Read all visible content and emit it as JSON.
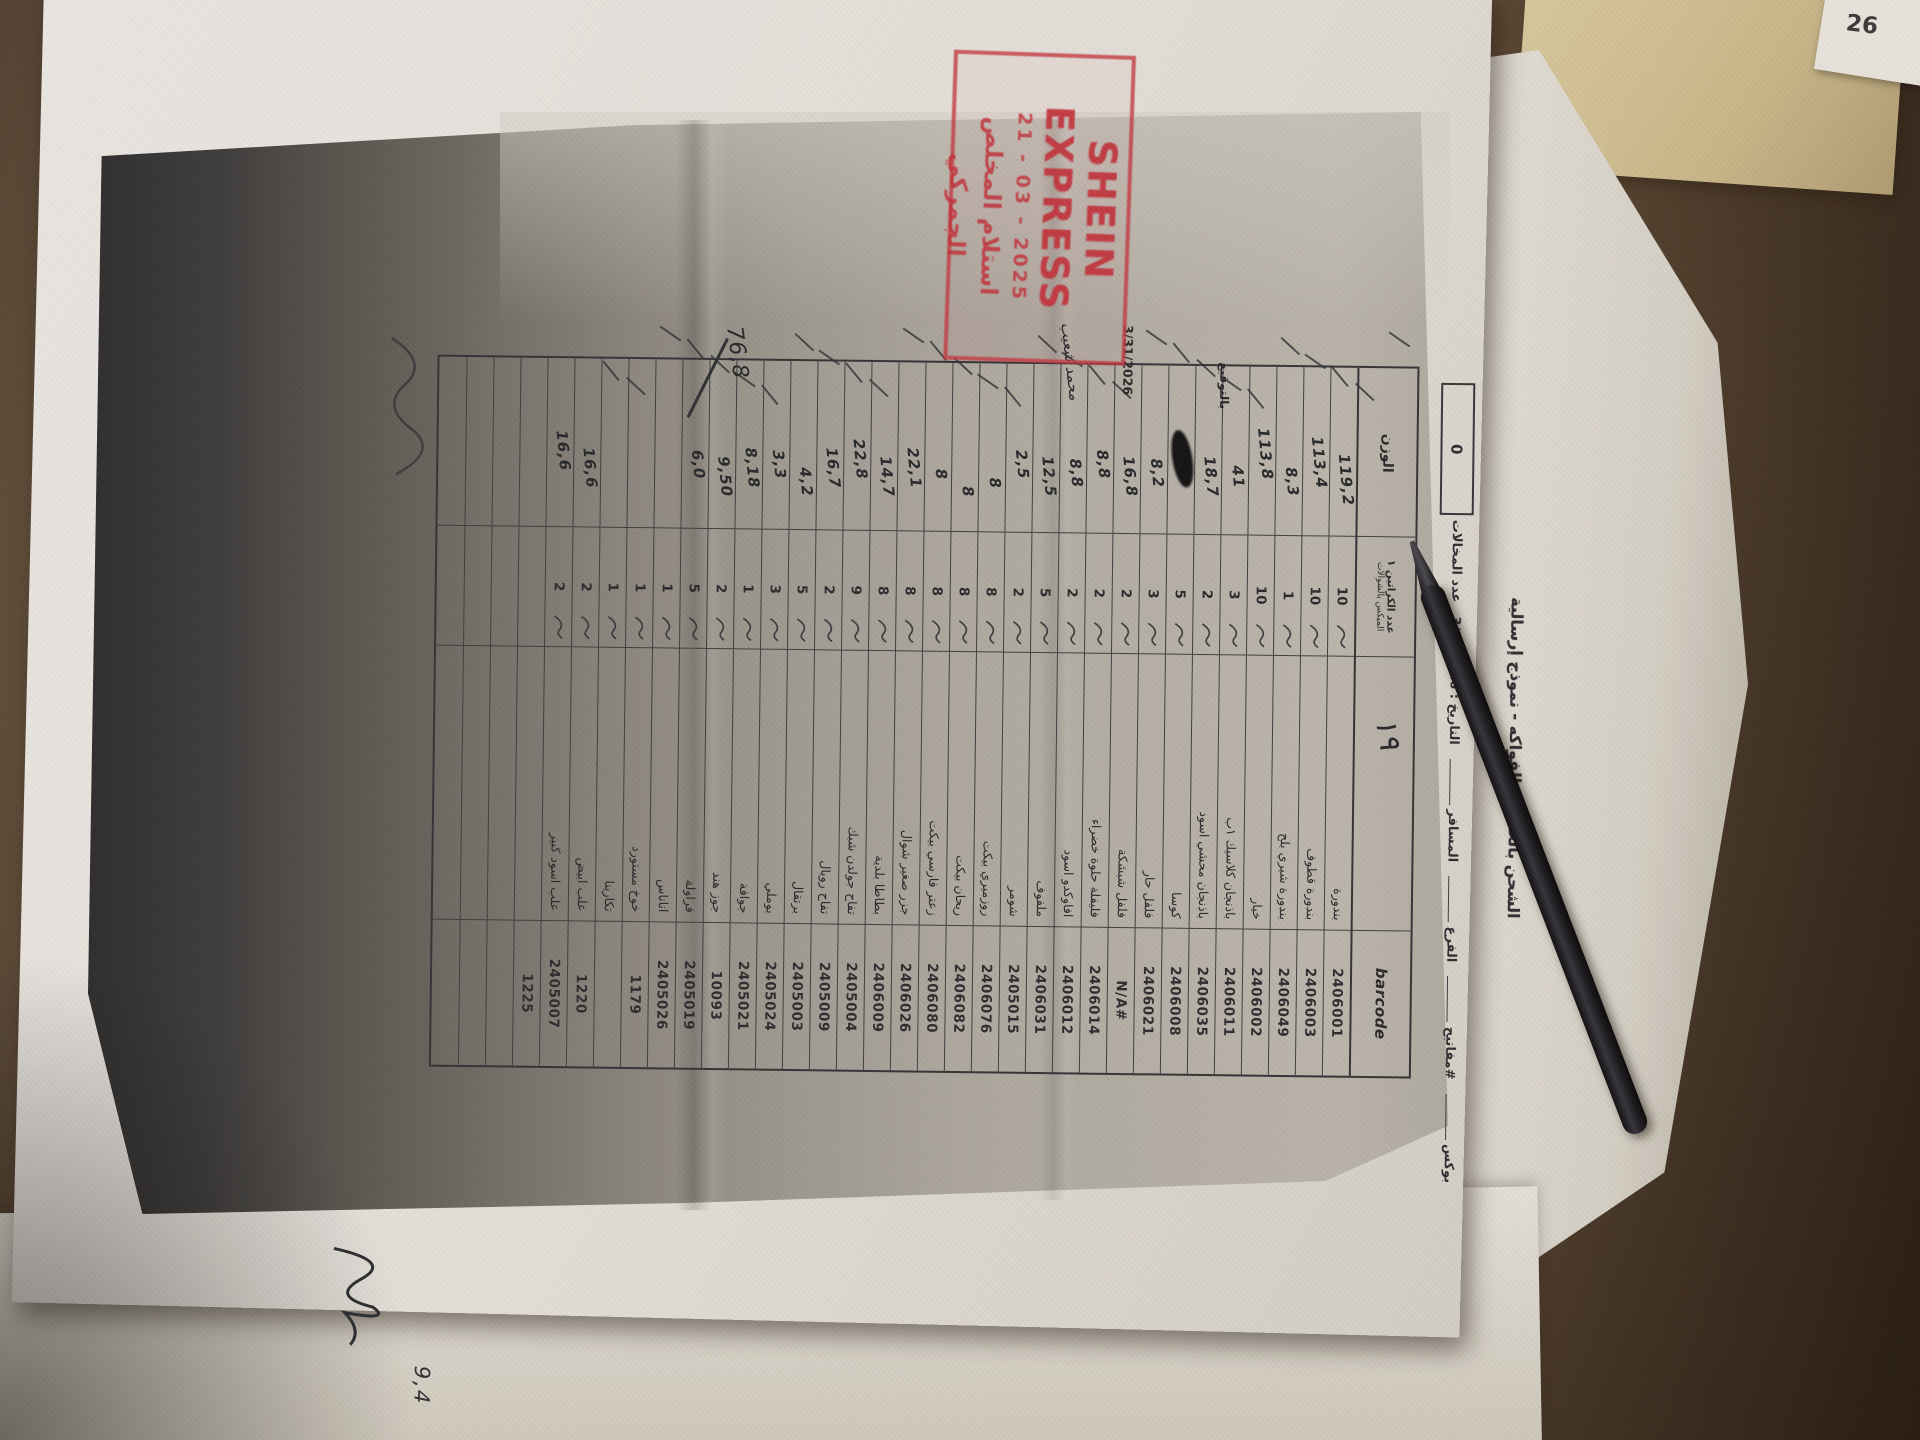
{
  "scene": {
    "corner_note": "26",
    "bottom_note": "9,4"
  },
  "stamp": {
    "line1": "SHEIN EXPRESS",
    "date": "21 - 03 - 2025",
    "line3": "استلام المخلص الجمركي"
  },
  "doc": {
    "title": "الشحن بالخضار والفواكه - نموذج إرسالية",
    "fields": {
      "box_label": "بوكس",
      "keys_label": "#مفاتيح",
      "branch_label": "الفرع",
      "traveler_label": "المسافر",
      "date_label": "التاريخ",
      "date_value": "3/31/2026",
      "violations_label": "عدد المخالات",
      "violations_value": "0"
    },
    "columns": {
      "weight": "الوزن",
      "qty_line1": "عدد الكراتين ١",
      "qty_line2": "المبكس بالشوالات",
      "name_note": "١٩",
      "barcode": "barcode"
    },
    "margin": {
      "sign_label": "بالتوقيع",
      "date": "3/31/2026",
      "signed_name": "محمد شعيب",
      "total": "76,8"
    },
    "rows": [
      {
        "barcode": "2406001",
        "name": "بندورة",
        "qty": "10",
        "weight": "119,2"
      },
      {
        "barcode": "2406003",
        "name": "بندورة قطوف",
        "qty": "10",
        "weight": "113,4"
      },
      {
        "barcode": "2406049",
        "name": "بندورة شيري بلح",
        "qty": "1",
        "weight": "8,3"
      },
      {
        "barcode": "2406002",
        "name": "خيار",
        "qty": "10",
        "weight": "113,8"
      },
      {
        "barcode": "2406011",
        "name": "باذنجان كلاسيك ١ب",
        "qty": "3",
        "weight": "41"
      },
      {
        "barcode": "2406035",
        "name": "باذنجان محشي اسود",
        "qty": "2",
        "weight": "18,7"
      },
      {
        "barcode": "2406008",
        "name": "كوسا",
        "qty": "5",
        "weight": "",
        "blot": true
      },
      {
        "barcode": "2406021",
        "name": "فلفل حار",
        "qty": "3",
        "weight": "8,2"
      },
      {
        "barcode": "#N/A",
        "name": "فلفل شبشكة",
        "qty": "2",
        "weight": "16,8"
      },
      {
        "barcode": "2406014",
        "name": "فليفلة حلوة خضراء",
        "qty": "2",
        "weight": "8,8"
      },
      {
        "barcode": "2406012",
        "name": "افاوكدو اسود",
        "qty": "2",
        "weight": "8,8"
      },
      {
        "barcode": "2406031",
        "name": "ملفوف",
        "qty": "5",
        "weight": "12,5"
      },
      {
        "barcode": "2405015",
        "name": "شومر",
        "qty": "2",
        "weight": "2,5"
      },
      {
        "barcode": "2406076",
        "name": "روزميري بيكت",
        "qty": "8",
        "weight": "8"
      },
      {
        "barcode": "2406082",
        "name": "ريحان بيكت",
        "qty": "8",
        "weight": "8"
      },
      {
        "barcode": "2406080",
        "name": "زعتر فارسي بيكت",
        "qty": "8",
        "weight": "8"
      },
      {
        "barcode": "2406026",
        "name": "جزر صغير شوال",
        "qty": "8",
        "weight": "22,1"
      },
      {
        "barcode": "2406009",
        "name": "بطاطا بلدية",
        "qty": "8",
        "weight": "14,7"
      },
      {
        "barcode": "2405004",
        "name": "تفاح جولدن شبك",
        "qty": "9",
        "weight": "22,8"
      },
      {
        "barcode": "2405009",
        "name": "تفاح رويال",
        "qty": "2",
        "weight": "16,7"
      },
      {
        "barcode": "2405003",
        "name": "برتقال",
        "qty": "5",
        "weight": "4,2"
      },
      {
        "barcode": "2405024",
        "name": "بوملي",
        "qty": "3",
        "weight": "3,3"
      },
      {
        "barcode": "2405021",
        "name": "جوافة",
        "qty": "1",
        "weight": "8,18"
      },
      {
        "barcode": "10093",
        "name": "جوز هند",
        "qty": "2",
        "weight": "9,50"
      },
      {
        "barcode": "2405019",
        "name": "فراولة",
        "qty": "5",
        "weight": "6,0"
      },
      {
        "barcode": "2405026",
        "name": "اناناس",
        "qty": "1",
        "weight": ""
      },
      {
        "barcode": "1179",
        "name": "خوخ مستورد",
        "qty": "1",
        "weight": ""
      },
      {
        "barcode": "",
        "name": "تكارينا",
        "qty": "1",
        "weight": ""
      },
      {
        "barcode": "1220",
        "name": "علب ابيض",
        "qty": "2",
        "weight": "16,6"
      },
      {
        "barcode": "2405007",
        "name": "علب اسود كبير",
        "qty": "2",
        "weight": "16,6"
      },
      {
        "barcode": "1225",
        "name": "",
        "qty": "",
        "weight": ""
      },
      {
        "barcode": "",
        "name": "",
        "qty": "",
        "weight": ""
      },
      {
        "barcode": "",
        "name": "",
        "qty": "",
        "weight": ""
      },
      {
        "barcode": "",
        "name": "",
        "qty": "",
        "weight": ""
      }
    ]
  }
}
